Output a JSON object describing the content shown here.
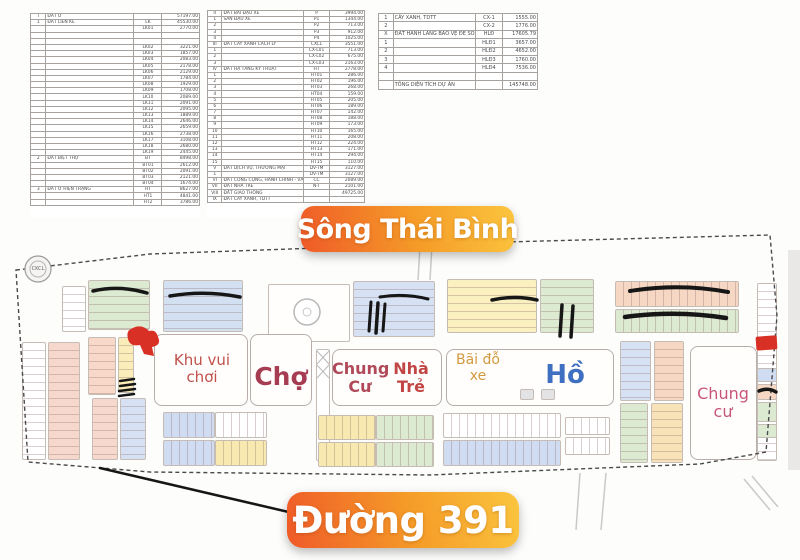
{
  "banners": {
    "river": "Sông Thái Bình",
    "road": "Đường 391"
  },
  "logo": {
    "text": "CKCL"
  },
  "labels": {
    "playground": "Khu vui chơi",
    "market": "Chợ",
    "apartment_center": "Chung Cư",
    "kindergarten": "Nhà Trẻ",
    "parking": "Bãi đỗ xe",
    "lake": "Hồ",
    "apartment_right": "Chung cư"
  },
  "note": {
    "text": "04.096.03.600.60"
  },
  "colors": {
    "banner_orange": "#ef5a28",
    "banner_mid": "#f59d28",
    "banner_yellow": "#fbc53e",
    "label_red": "#c0504a",
    "market_red": "#a63c52",
    "apartment_red": "#b04a5a",
    "kindergarten_red": "#c24545",
    "parking_orange": "#d29a3e",
    "lake_blue": "#3f6fc0",
    "apartment_pink": "#c7567a",
    "marker_red": "#d93025"
  },
  "tables": {
    "left": {
      "rows": [
        [
          "I",
          "ĐẤT Ở",
          "",
          "57197.00"
        ],
        [
          "1",
          "ĐẤT LIỀN KỀ",
          "LK",
          "45530.00"
        ],
        [
          "",
          "",
          "LK01",
          "2770.00"
        ],
        [
          "",
          "",
          "",
          ""
        ],
        [
          "",
          "",
          "",
          ""
        ],
        [
          "",
          "",
          "LK02",
          "3221.00"
        ],
        [
          "",
          "",
          "LK03",
          "1857.00"
        ],
        [
          "",
          "",
          "LK04",
          "2083.00"
        ],
        [
          "",
          "",
          "LK05",
          "2178.00"
        ],
        [
          "",
          "",
          "LK06",
          "2129.00"
        ],
        [
          "",
          "",
          "LK07",
          "1784.00"
        ],
        [
          "",
          "",
          "LK08",
          "1929.00"
        ],
        [
          "",
          "",
          "LK09",
          "1708.00"
        ],
        [
          "",
          "",
          "LK10",
          "2089.00"
        ],
        [
          "",
          "",
          "LK11",
          "2091.00"
        ],
        [
          "",
          "",
          "LK12",
          "2095.00"
        ],
        [
          "",
          "",
          "LK13",
          "1889.00"
        ],
        [
          "",
          "",
          "LK14",
          "2646.00"
        ],
        [
          "",
          "",
          "LK15",
          "2659.00"
        ],
        [
          "",
          "",
          "LK16",
          "2738.00"
        ],
        [
          "",
          "",
          "LK17",
          "3108.00"
        ],
        [
          "",
          "",
          "LK18",
          "2680.00"
        ],
        [
          "",
          "",
          "LK19",
          "2445.00"
        ],
        [
          "2",
          "ĐẤT BIỆT THỰ",
          "BT",
          "8498.00"
        ],
        [
          "",
          "",
          "BT01",
          "2612.00"
        ],
        [
          "",
          "",
          "BT02",
          "2091.00"
        ],
        [
          "",
          "",
          "BT03",
          "2121.00"
        ],
        [
          "",
          "",
          "BT04",
          "1674.00"
        ],
        [
          "3",
          "ĐẤT Ở HIỆN TRẠNG",
          "HT",
          "8627.00"
        ],
        [
          "",
          "",
          "HT1",
          "4841.00"
        ],
        [
          "",
          "",
          "HT2",
          "3786.00"
        ]
      ]
    },
    "middle": {
      "rows": [
        [
          "II",
          "ĐẤT BÃI ĐẬU XE",
          "P",
          "3994.00"
        ],
        [
          "1",
          "SÂN ĐẬU XE",
          "P1",
          "1344.00"
        ],
        [
          "2",
          "",
          "P2",
          "713.00"
        ],
        [
          "3",
          "",
          "P3",
          "912.00"
        ],
        [
          "4",
          "",
          "P4",
          "1025.00"
        ],
        [
          "III",
          "ĐẤT CÂY XANH CÁCH LY",
          "CXCL",
          "3551.00"
        ],
        [
          "1",
          "",
          "CX-L01",
          "713.00"
        ],
        [
          "2",
          "",
          "CX-L02",
          "675.00"
        ],
        [
          "3",
          "",
          "CX-L03",
          "2163.00"
        ],
        [
          "IV",
          "ĐẤT HẠ TẦNG KỸ THUẬT",
          "HT",
          "2778.00"
        ],
        [
          "1",
          "",
          "HT01",
          "286.00"
        ],
        [
          "2",
          "",
          "HT02",
          "196.00"
        ],
        [
          "3",
          "",
          "HT03",
          "268.00"
        ],
        [
          "4",
          "",
          "HT04",
          "159.00"
        ],
        [
          "5",
          "",
          "HT05",
          "205.00"
        ],
        [
          "6",
          "",
          "HT06",
          "189.00"
        ],
        [
          "7",
          "",
          "HT07",
          "142.00"
        ],
        [
          "8",
          "",
          "HT08",
          "188.00"
        ],
        [
          "9",
          "",
          "HT09",
          "173.00"
        ],
        [
          "10",
          "",
          "HT10",
          "165.00"
        ],
        [
          "11",
          "",
          "HT11",
          "208.00"
        ],
        [
          "12",
          "",
          "HT12",
          "224.00"
        ],
        [
          "13",
          "",
          "HT13",
          "171.00"
        ],
        [
          "14",
          "",
          "HT14",
          "294.00"
        ],
        [
          "15",
          "",
          "HT15",
          "110.00"
        ],
        [
          "V",
          "ĐẤT DỊCH VỤ, THƯƠNG MẠI",
          "DV-TM",
          "3127.00"
        ],
        [
          "1",
          "",
          "DV-TM",
          "3127.00"
        ],
        [
          "VI",
          "ĐẤT CÔNG CỘNG, HÀNH CHÍNH - VĂN HÓA",
          "CC",
          "2089.00"
        ],
        [
          "VII",
          "ĐẤT NHÀ TRẺ",
          "N-T",
          "2101.00"
        ],
        [
          "VIII",
          "ĐẤT GIAO THÔNG",
          "",
          "49725.00"
        ],
        [
          "IX",
          "ĐẤT CÂY XANH, TDTT",
          "",
          ""
        ]
      ]
    },
    "right": {
      "rows": [
        [
          "1",
          "CÂY XANH, TDTT",
          "CX-1",
          "1555.00"
        ],
        [
          "2",
          "",
          "CX-2",
          "1776.00"
        ],
        [
          "X",
          "ĐẤT HÀNH LANG BẢO VỆ ĐÊ SÔNG",
          "HLĐ",
          "17605.79"
        ],
        [
          "1",
          "",
          "HLĐ1",
          "3657.00"
        ],
        [
          "2",
          "",
          "HLĐ2",
          "4652.00"
        ],
        [
          "3",
          "",
          "HLĐ3",
          "1760.00"
        ],
        [
          "4",
          "",
          "HLĐ4",
          "7536.00"
        ],
        [
          "",
          "",
          "",
          ""
        ],
        [
          "",
          "TỔNG DIỆN TÍCH DỰ ÁN",
          "",
          "145748.00"
        ]
      ]
    }
  }
}
